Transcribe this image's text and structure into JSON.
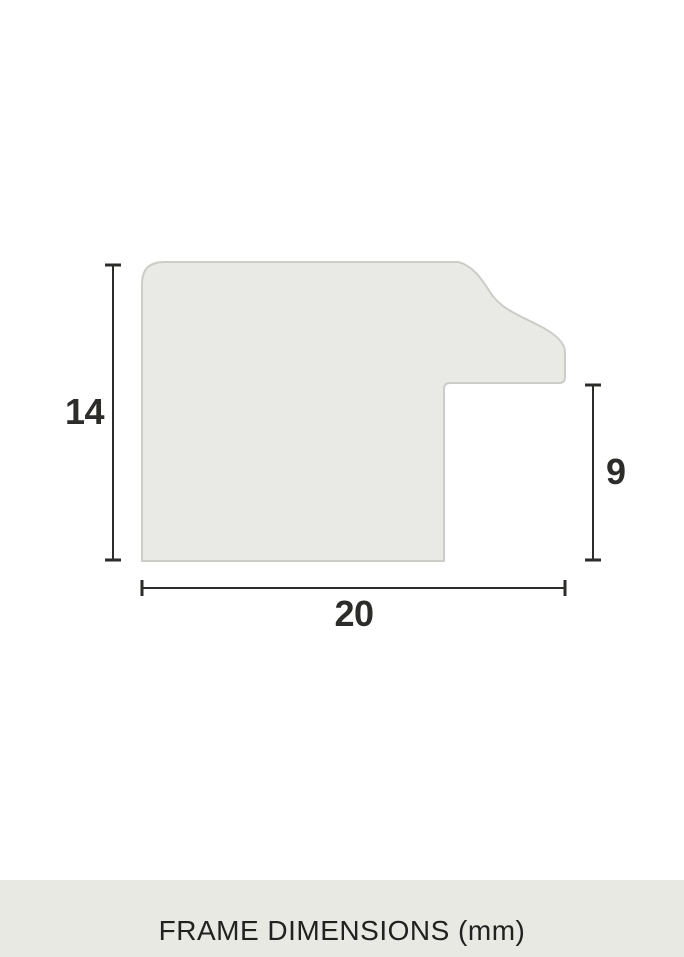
{
  "title": "Frame profile cross-section diagram",
  "diagram": {
    "height_label": "14",
    "rabbet_label": "9",
    "width_label": "20",
    "unit": "mm",
    "dimensions_mm": {
      "height": 14,
      "rabbet_height": 9,
      "width": 20
    }
  },
  "footer": {
    "label": "FRAME DIMENSIONS (mm)"
  },
  "colors": {
    "background": "#ffffff",
    "profile_fill": "#e9eae5",
    "profile_stroke": "#cccdc8",
    "dimension_ink": "#2c2c2a",
    "footer_bg": "#e9e9e4",
    "footer_text": "#21211f"
  }
}
